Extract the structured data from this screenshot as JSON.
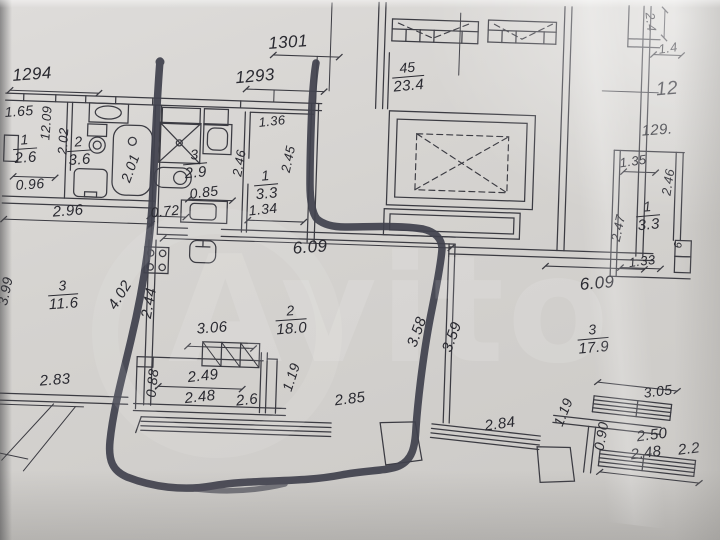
{
  "page": {
    "kind": "floor-plan-photo"
  },
  "watermark": {
    "text": "Avito"
  },
  "colors": {
    "paper": "#d5d3d0",
    "ink": "#3b3b42",
    "marker": "#41424e",
    "label": "#2a2a31"
  },
  "plan": {
    "rooms": [
      {
        "id": "left-room",
        "number": "1",
        "area": "2.6"
      },
      {
        "id": "left-bathroom",
        "number": "2",
        "area": "3.6"
      },
      {
        "id": "middle-bathroom",
        "number": "3",
        "area": "2.9"
      },
      {
        "id": "hall",
        "number": "1",
        "area": "3.3"
      },
      {
        "id": "kitchen-room",
        "number": "3",
        "area": "11.6"
      },
      {
        "id": "living-room",
        "number": "2",
        "area": "18.0"
      },
      {
        "id": "right-room",
        "number": "3",
        "area": "17.9"
      },
      {
        "id": "right-closet",
        "number": "1",
        "area": "3.3"
      },
      {
        "id": "stair-block",
        "number": "45",
        "area": "23.4"
      }
    ],
    "fractions": [
      {
        "num": "1",
        "den": "2.6",
        "x": 25,
        "y": 149,
        "r": -4
      },
      {
        "num": "2",
        "den": "3.6",
        "x": 79,
        "y": 151,
        "r": -4
      },
      {
        "num": "3",
        "den": "2.9",
        "x": 195,
        "y": 164,
        "r": -5
      },
      {
        "num": "1",
        "den": "3.3",
        "x": 266,
        "y": 185,
        "r": -5
      },
      {
        "num": "45",
        "den": "23.4",
        "x": 408,
        "y": 77,
        "r": -5
      },
      {
        "num": "3",
        "den": "11.6",
        "x": 63,
        "y": 295,
        "r": -4
      },
      {
        "num": "2",
        "den": "18.0",
        "x": 291,
        "y": 320,
        "r": -4
      },
      {
        "num": "3",
        "den": "17.9",
        "x": 593,
        "y": 339,
        "r": -5
      },
      {
        "num": "1",
        "den": "3.3",
        "x": 648,
        "y": 216,
        "r": -5
      }
    ],
    "dim_labels": [
      {
        "t": "1294",
        "x": 32,
        "y": 74,
        "r": -4,
        "s": 17
      },
      {
        "t": "1.65",
        "x": 19,
        "y": 111,
        "r": -4,
        "s": 14
      },
      {
        "t": "12.09",
        "x": 46,
        "y": 123,
        "r": -86,
        "s": 13
      },
      {
        "t": "2.02",
        "x": 63,
        "y": 141,
        "r": -86,
        "s": 13
      },
      {
        "t": "2.01",
        "x": 130,
        "y": 168,
        "r": -70,
        "s": 14
      },
      {
        "t": "0.96",
        "x": 30,
        "y": 184,
        "r": -4,
        "s": 14
      },
      {
        "t": "2.96",
        "x": 68,
        "y": 211,
        "r": -4,
        "s": 15
      },
      {
        "t": "1301",
        "x": 288,
        "y": 42,
        "r": -4,
        "s": 17
      },
      {
        "t": "1293",
        "x": 255,
        "y": 76,
        "r": -5,
        "s": 17
      },
      {
        "t": "1.36",
        "x": 272,
        "y": 121,
        "r": -6,
        "s": 13
      },
      {
        "t": "2.45",
        "x": 288,
        "y": 159,
        "r": -78,
        "s": 13
      },
      {
        "t": "2.46",
        "x": 239,
        "y": 163,
        "r": -80,
        "s": 13
      },
      {
        "t": "0.85",
        "x": 204,
        "y": 192,
        "r": -7,
        "s": 14
      },
      {
        "t": "0.72",
        "x": 165,
        "y": 211,
        "r": -6,
        "s": 14
      },
      {
        "t": "1.34",
        "x": 263,
        "y": 209,
        "r": -6,
        "s": 14
      },
      {
        "t": "6.09",
        "x": 310,
        "y": 247,
        "r": -4,
        "s": 17
      },
      {
        "t": "2.4",
        "x": 651,
        "y": 22,
        "r": 84,
        "s": 13
      },
      {
        "t": "1.4",
        "x": 668,
        "y": 48,
        "r": -8,
        "s": 13
      },
      {
        "t": "12",
        "x": 667,
        "y": 89,
        "r": -5,
        "s": 19
      },
      {
        "t": "129.",
        "x": 657,
        "y": 130,
        "r": -4,
        "s": 15
      },
      {
        "t": "1.35",
        "x": 633,
        "y": 161,
        "r": -8,
        "s": 13
      },
      {
        "t": "2.46",
        "x": 668,
        "y": 182,
        "r": -81,
        "s": 13
      },
      {
        "t": "2.47",
        "x": 618,
        "y": 228,
        "r": -78,
        "s": 13
      },
      {
        "t": "1.33",
        "x": 642,
        "y": 261,
        "r": -7,
        "s": 13
      },
      {
        "t": "6",
        "x": 679,
        "y": 245,
        "r": -85,
        "s": 11
      },
      {
        "t": "6.09",
        "x": 597,
        "y": 283,
        "r": -5,
        "s": 17
      },
      {
        "t": "3.06",
        "x": 212,
        "y": 328,
        "r": -4,
        "s": 15
      },
      {
        "t": "3.58",
        "x": 417,
        "y": 332,
        "r": -70,
        "s": 15
      },
      {
        "t": "3.59",
        "x": 452,
        "y": 337,
        "r": -70,
        "s": 15
      },
      {
        "t": "4.02",
        "x": 120,
        "y": 295,
        "r": -58,
        "s": 15
      },
      {
        "t": "2.44",
        "x": 149,
        "y": 303,
        "r": -80,
        "s": 15
      },
      {
        "t": "3.99",
        "x": 5,
        "y": 291,
        "r": -78,
        "s": 14
      },
      {
        "t": "2.83",
        "x": 55,
        "y": 380,
        "r": -4,
        "s": 15
      },
      {
        "t": "0.88",
        "x": 152,
        "y": 383,
        "r": -84,
        "s": 14
      },
      {
        "t": "2.49",
        "x": 203,
        "y": 376,
        "r": -6,
        "s": 15
      },
      {
        "t": "2.48",
        "x": 200,
        "y": 397,
        "r": -6,
        "s": 15
      },
      {
        "t": "2.6",
        "x": 247,
        "y": 400,
        "r": -6,
        "s": 15
      },
      {
        "t": "1.19",
        "x": 291,
        "y": 377,
        "r": -72,
        "s": 14
      },
      {
        "t": "2.85",
        "x": 350,
        "y": 399,
        "r": -7,
        "s": 15
      },
      {
        "t": "2.84",
        "x": 500,
        "y": 424,
        "r": -8,
        "s": 15
      },
      {
        "t": "1.19",
        "x": 563,
        "y": 412,
        "r": -68,
        "s": 14
      },
      {
        "t": "0.90",
        "x": 601,
        "y": 436,
        "r": -80,
        "s": 14
      },
      {
        "t": "3.05",
        "x": 658,
        "y": 391,
        "r": -7,
        "s": 14
      },
      {
        "t": "2.50",
        "x": 652,
        "y": 435,
        "r": -7,
        "s": 15
      },
      {
        "t": "2.48",
        "x": 646,
        "y": 453,
        "r": -7,
        "s": 15
      },
      {
        "t": "2.2",
        "x": 689,
        "y": 449,
        "r": -7,
        "s": 15
      }
    ]
  }
}
